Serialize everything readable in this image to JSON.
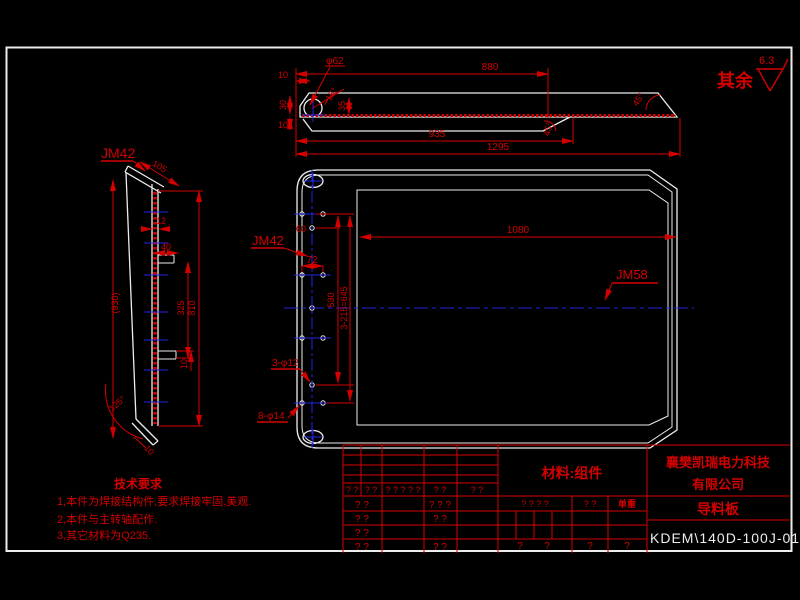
{
  "colors": {
    "background": "#000000",
    "outline": "#ededed",
    "dimension_red": "#d40000",
    "centerline_blue": "#2525e0"
  },
  "surface_finish": {
    "prefix": "其余",
    "roughness": "6.3"
  },
  "top_view": {
    "phi62": "φ62",
    "d880": "880",
    "d10_top": "10",
    "d30": "30",
    "d10_bottom": "10",
    "d35": "35",
    "a15": "15°",
    "d935": "935",
    "d1295": "1295",
    "a45_right": "45°",
    "a45_notch": "45°"
  },
  "left_view": {
    "label": "JM42",
    "d105": "105",
    "d12": "12",
    "d40": "40",
    "d10_tab": "10",
    "d930": "(930)",
    "d325": "325",
    "d810": "810",
    "a125": "125°",
    "d10_foot": "10"
  },
  "main_view": {
    "label_jm42": "JM42",
    "label_jm58": "JM58",
    "d60": "60",
    "d72": "72",
    "d530": "530",
    "d645": "3-215=645",
    "d1080": "1080",
    "holes_12": "3-φ12",
    "holes_14": "8-φ14"
  },
  "tech_requirements": {
    "title": "技术要求",
    "item1": "1,本件为焊接结构件,要求焊接牢固,美观.",
    "item2": "2,本件与主转轴配作.",
    "item3": "3,其它材料为Q235."
  },
  "title_block": {
    "material": "材料:组件",
    "unit_weight": "单重",
    "company_line1": "襄樊凯瑞电力科技",
    "company_line2": "有限公司",
    "part_name": "导料板",
    "drawing_number": "KDEM\\140D-100J-01",
    "rev_header": [
      "? ?",
      "? ?",
      "? ? ? ? ?",
      "? ?",
      "? ?"
    ],
    "rev_rows": [
      [
        "? ?",
        "? ? ?"
      ],
      [
        "? ?",
        "? ?"
      ],
      [
        "? ?",
        ""
      ],
      [
        "? ?",
        "? ?"
      ]
    ],
    "sign_row": [
      "? ? ? ?",
      "? ?"
    ],
    "bottom_row": [
      "?",
      "?",
      "?",
      "?"
    ]
  }
}
